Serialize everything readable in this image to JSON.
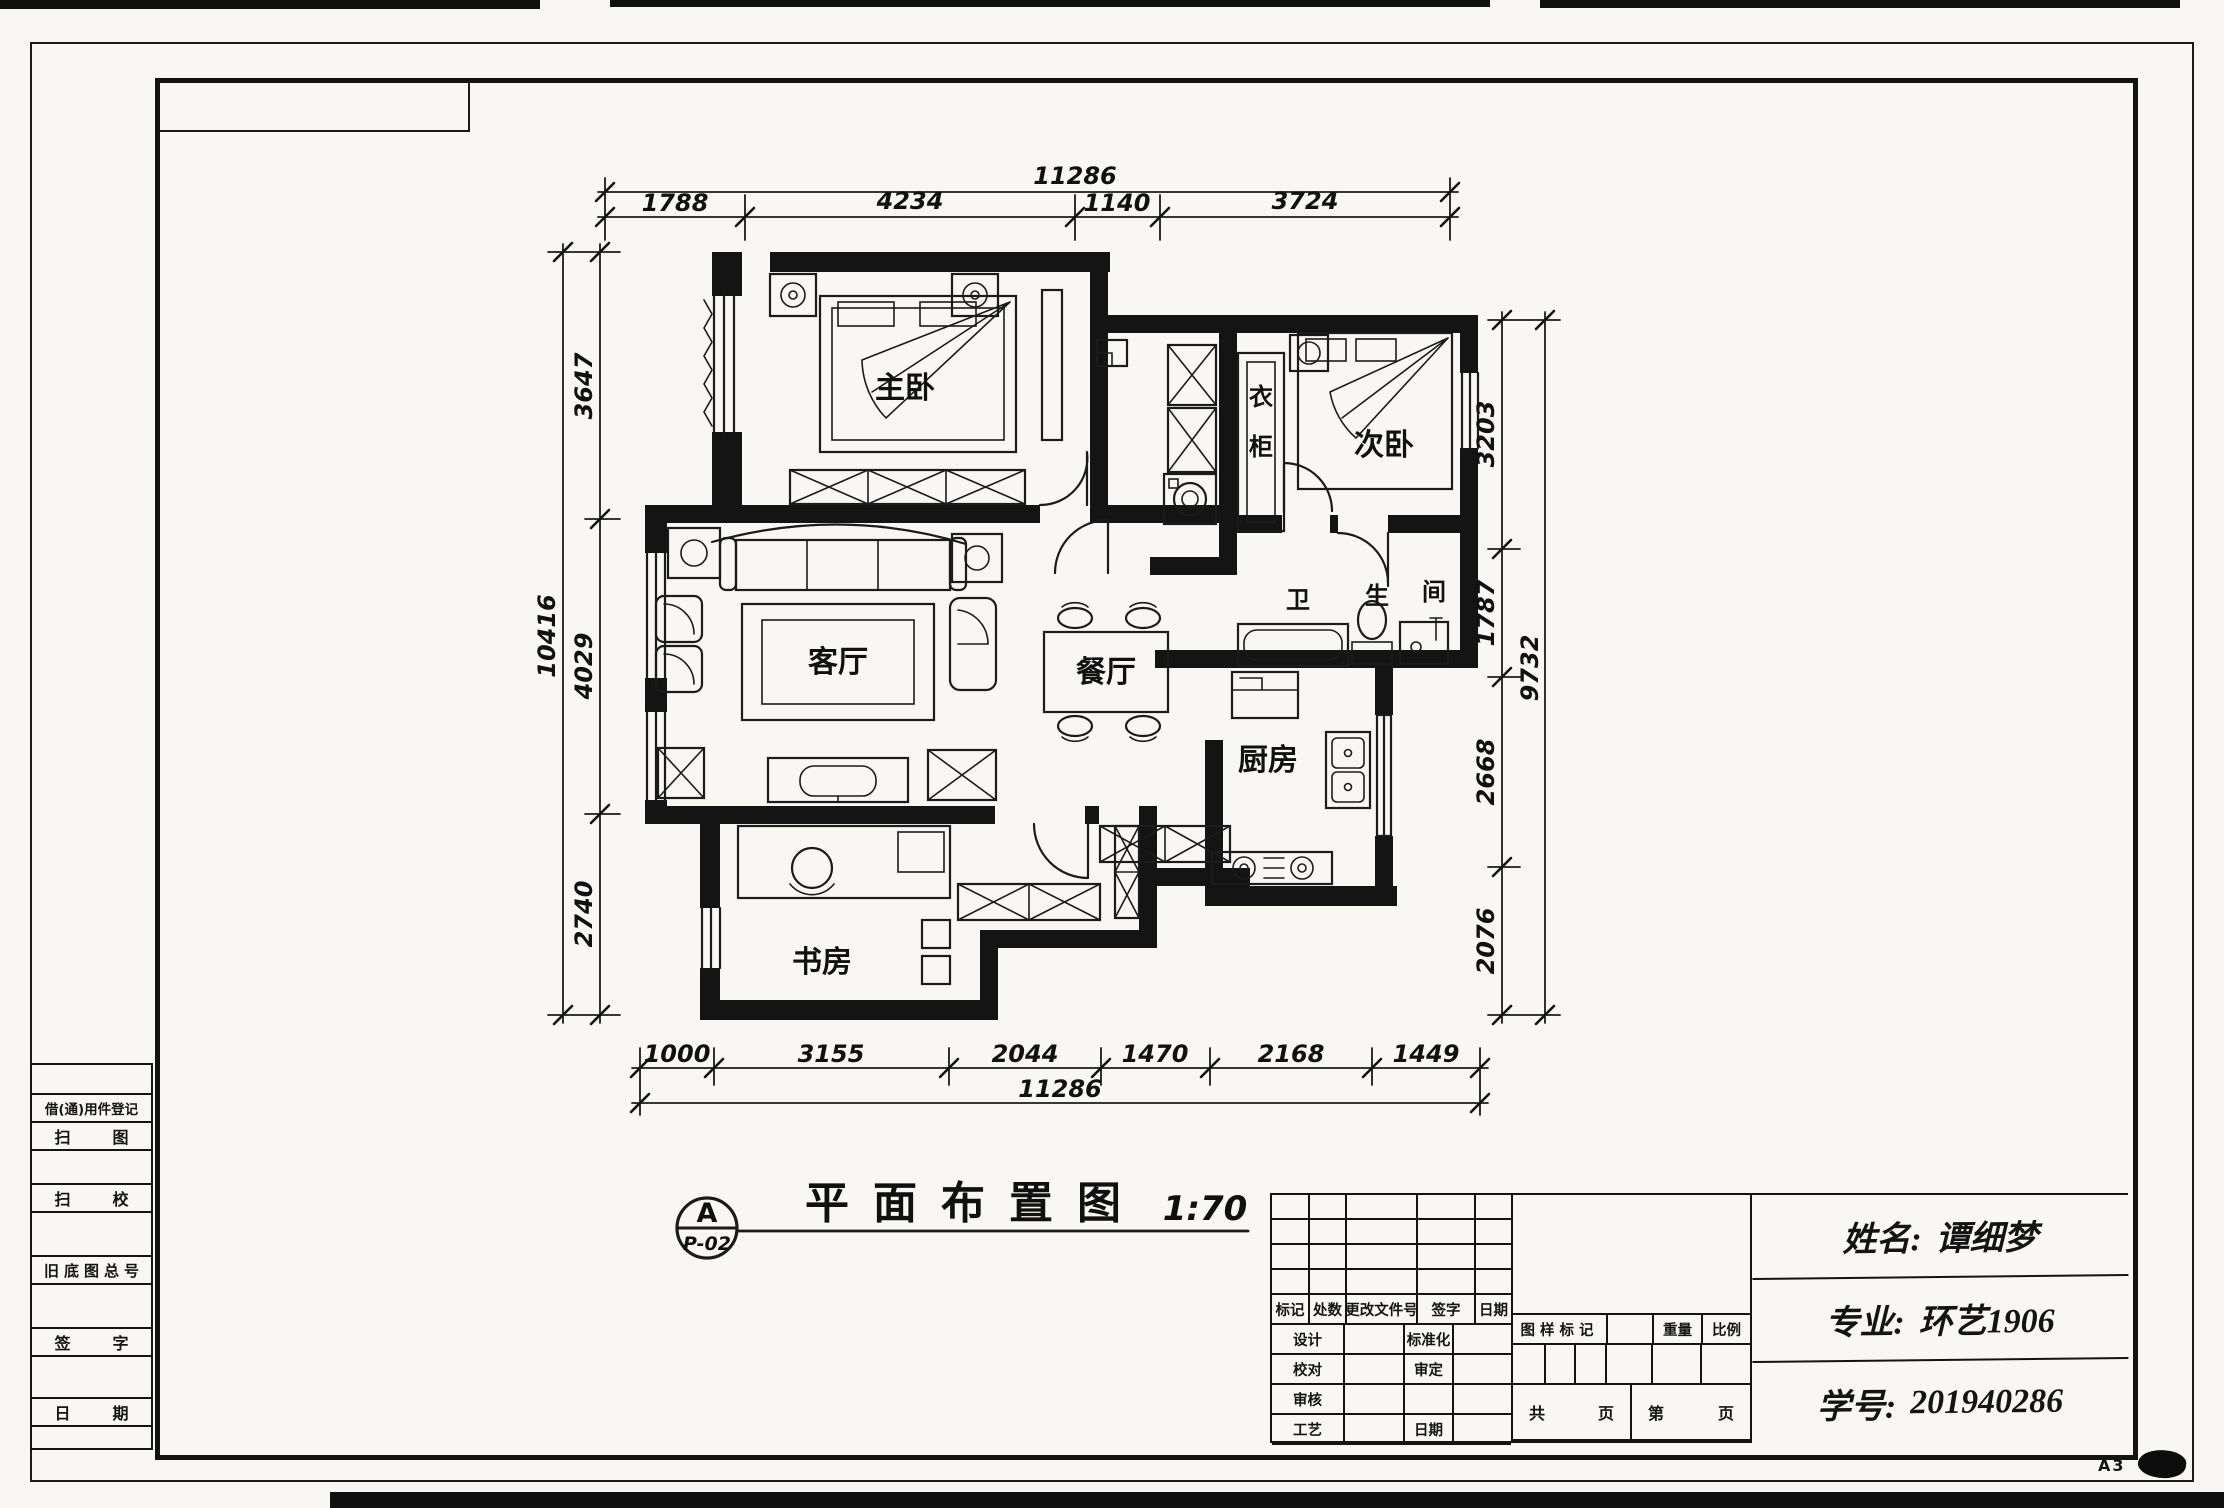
{
  "sheet": {
    "size_label": "A3"
  },
  "plan_title": {
    "ref_letter": "A",
    "ref_code": "P-02",
    "text": "平面布置图",
    "scale": "1:70"
  },
  "rooms": {
    "master": "主卧",
    "second": "次卧",
    "wardrobe_c1": "衣",
    "wardrobe_c2": "柜",
    "living": "客厅",
    "dining": "餐厅",
    "kitchen": "厨房",
    "study": "书房",
    "bath_c1": "卫",
    "bath_c2": "生",
    "bath_c3": "间"
  },
  "dims": {
    "top": {
      "overall": "11286",
      "segments": [
        "1788",
        "4234",
        "1140",
        "3724"
      ]
    },
    "bottom": {
      "overall": "11286",
      "segments": [
        "1000",
        "3155",
        "2044",
        "1470",
        "2168",
        "1449"
      ]
    },
    "left": {
      "overall": "10416",
      "segments": [
        "3647",
        "4029",
        "2740"
      ]
    },
    "right": {
      "overall": "9732",
      "segments": [
        "3203",
        "1787",
        "2668",
        "2076"
      ]
    }
  },
  "register_strip": {
    "rows": [
      "借(通)用件登记",
      "扫图",
      "扫校",
      "旧底图总号",
      "签字",
      "日期"
    ]
  },
  "titleblock": {
    "header": [
      "标记",
      "处数",
      "更改文件号",
      "签字",
      "日期"
    ],
    "rows": [
      {
        "a": "设计",
        "b": "标准化"
      },
      {
        "a": "校对",
        "b": "审定"
      },
      {
        "a": "审核",
        "b": ""
      },
      {
        "a": "工艺",
        "b": "日期"
      }
    ],
    "right": {
      "sample_mark": "图样标记",
      "weight": "重量",
      "ratio": "比例",
      "total_label": "共",
      "total_unit": "页",
      "index_label": "第",
      "index_unit": "页"
    },
    "info": [
      {
        "label": "姓名:",
        "value": "谭细梦"
      },
      {
        "label": "专业:",
        "value": "环艺1906"
      },
      {
        "label": "学号:",
        "value": "201940286"
      }
    ]
  }
}
